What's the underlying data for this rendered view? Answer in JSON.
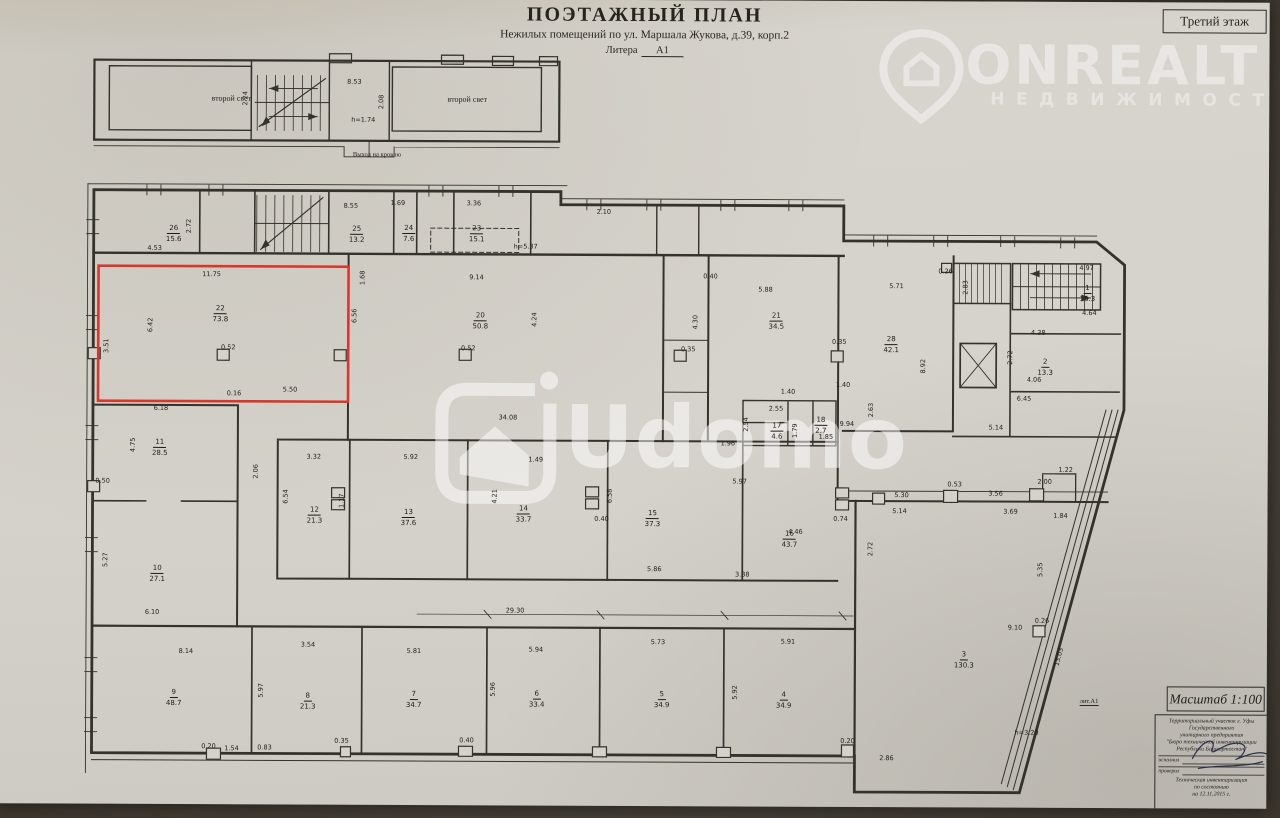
{
  "meta": {
    "title": "ПОЭТАЖНЫЙ ПЛАН",
    "subtitle": "Нежилых помещений по ул. Маршала Жукова, д.39, корп.2",
    "litera_label": "Литера",
    "litera_value": "А1",
    "floor": "Третий этаж"
  },
  "watermarks": {
    "onrealt": {
      "name": "ONREALT",
      "sub": "НЕДВИЖИМОСТЬ"
    },
    "udomo": {
      "name": "Udomo"
    }
  },
  "scale_box": "Масштаб  1:100",
  "lit_note": "лит.А1",
  "stamp": {
    "lines": [
      "Территориальный участок г. Уфы",
      "Государственного",
      "унитарного предприятия",
      "\"Бюро технической инвентаризации",
      "Республики Башкортостан\""
    ],
    "rows": [
      {
        "label": "исполнил"
      },
      {
        "label": "проверил"
      }
    ],
    "footer": [
      "Техническая инвентаризация",
      "по состоянию",
      "на  12.11.2015 г."
    ]
  },
  "plan": {
    "highlight_color": "#d6392c",
    "texts": [
      {
        "t": "второй свет",
        "x": 232,
        "y": 100,
        "fs": 8
      },
      {
        "t": "второй свет",
        "x": 468,
        "y": 100,
        "fs": 8
      },
      {
        "t": "Выход на кровлю",
        "x": 378,
        "y": 156,
        "fs": 6.5
      }
    ],
    "rooms": [
      {
        "n": "26",
        "a": "15.6",
        "x": 175,
        "y": 232
      },
      {
        "n": "25",
        "a": "13.2",
        "x": 358,
        "y": 232
      },
      {
        "n": "24",
        "a": "7.6",
        "x": 410,
        "y": 231
      },
      {
        "n": "23",
        "a": "15.1",
        "x": 478,
        "y": 231
      },
      {
        "n": "22",
        "a": "73.8",
        "x": 222,
        "y": 312
      },
      {
        "n": "20",
        "a": "50.8",
        "x": 482,
        "y": 318
      },
      {
        "n": "21",
        "a": "34.5",
        "x": 778,
        "y": 317
      },
      {
        "n": "28",
        "a": "42.1",
        "x": 893,
        "y": 340
      },
      {
        "n": "1",
        "a": "15.3",
        "x": 1089,
        "y": 288
      },
      {
        "n": "2",
        "a": "13.3",
        "x": 1047,
        "y": 362
      },
      {
        "n": "17",
        "a": "4.6",
        "x": 779,
        "y": 427
      },
      {
        "n": "18",
        "a": "2.7",
        "x": 823,
        "y": 421
      },
      {
        "n": "16",
        "a": "43.7",
        "x": 792,
        "y": 535
      },
      {
        "n": "11",
        "a": "28.5",
        "x": 162,
        "y": 446
      },
      {
        "n": "10",
        "a": "27.1",
        "x": 160,
        "y": 572
      },
      {
        "n": "12",
        "a": "21.3",
        "x": 317,
        "y": 513
      },
      {
        "n": "13",
        "a": "37.6",
        "x": 411,
        "y": 515
      },
      {
        "n": "14",
        "a": "33.7",
        "x": 526,
        "y": 511
      },
      {
        "n": "15",
        "a": "37.3",
        "x": 655,
        "y": 515
      },
      {
        "n": "9",
        "a": "48.7",
        "x": 177,
        "y": 696
      },
      {
        "n": "8",
        "a": "21.3",
        "x": 311,
        "y": 699
      },
      {
        "n": "7",
        "a": "34.7",
        "x": 417,
        "y": 697
      },
      {
        "n": "6",
        "a": "33.4",
        "x": 540,
        "y": 696
      },
      {
        "n": "5",
        "a": "34.9",
        "x": 665,
        "y": 696
      },
      {
        "n": "4",
        "a": "34.9",
        "x": 787,
        "y": 696
      },
      {
        "n": "3",
        "a": "130.3",
        "x": 967,
        "y": 655
      }
    ],
    "dims": [
      {
        "t": "8.53",
        "x": 355,
        "y": 83
      },
      {
        "t": "2.08",
        "x": 382,
        "y": 103,
        "v": 1
      },
      {
        "t": "h=1.74",
        "x": 364,
        "y": 121
      },
      {
        "t": "2.24",
        "x": 246,
        "y": 100,
        "v": 1
      },
      {
        "t": "4.53",
        "x": 156,
        "y": 250
      },
      {
        "t": "2.72",
        "x": 190,
        "y": 228,
        "v": 1
      },
      {
        "t": "8.55",
        "x": 352,
        "y": 207
      },
      {
        "t": "1.69",
        "x": 399,
        "y": 204
      },
      {
        "t": "3.36",
        "x": 475,
        "y": 204
      },
      {
        "t": "h=5.37",
        "x": 527,
        "y": 247
      },
      {
        "t": "2.10",
        "x": 605,
        "y": 212
      },
      {
        "t": "11.75",
        "x": 213,
        "y": 276
      },
      {
        "t": "6.42",
        "x": 152,
        "y": 327,
        "v": 1
      },
      {
        "t": "3.51",
        "x": 108,
        "y": 348,
        "v": 1
      },
      {
        "t": "0.52",
        "x": 230,
        "y": 349
      },
      {
        "t": "5.50",
        "x": 292,
        "y": 391
      },
      {
        "t": "0.16",
        "x": 236,
        "y": 395
      },
      {
        "t": "6.56",
        "x": 356,
        "y": 317,
        "v": 1
      },
      {
        "t": "1.68",
        "x": 364,
        "y": 279,
        "v": 1
      },
      {
        "t": "9.14",
        "x": 478,
        "y": 278
      },
      {
        "t": "4.24",
        "x": 536,
        "y": 320,
        "v": 1
      },
      {
        "t": "0.52",
        "x": 470,
        "y": 349
      },
      {
        "t": "4.30",
        "x": 697,
        "y": 322,
        "v": 1
      },
      {
        "t": "0.35",
        "x": 690,
        "y": 349
      },
      {
        "t": "5.88",
        "x": 767,
        "y": 289
      },
      {
        "t": "0.40",
        "x": 712,
        "y": 276
      },
      {
        "t": "0.35",
        "x": 841,
        "y": 341
      },
      {
        "t": "5.71",
        "x": 898,
        "y": 285
      },
      {
        "t": "8.92",
        "x": 925,
        "y": 365,
        "v": 1
      },
      {
        "t": "0.26",
        "x": 947,
        "y": 270
      },
      {
        "t": "1.40",
        "x": 845,
        "y": 384
      },
      {
        "t": "4.97",
        "x": 1088,
        "y": 266
      },
      {
        "t": "4.64",
        "x": 1091,
        "y": 311
      },
      {
        "t": "2.83",
        "x": 967,
        "y": 286,
        "v": 1
      },
      {
        "t": "4.38",
        "x": 1040,
        "y": 331
      },
      {
        "t": "2.72",
        "x": 1012,
        "y": 356,
        "v": 1
      },
      {
        "t": "4.06",
        "x": 1036,
        "y": 378
      },
      {
        "t": "6.45",
        "x": 1026,
        "y": 397
      },
      {
        "t": "5.14",
        "x": 998,
        "y": 426
      },
      {
        "t": "34.08",
        "x": 510,
        "y": 418
      },
      {
        "t": "1.49",
        "x": 538,
        "y": 460
      },
      {
        "t": "1.96",
        "x": 730,
        "y": 443
      },
      {
        "t": "5.97",
        "x": 742,
        "y": 481
      },
      {
        "t": "2.55",
        "x": 778,
        "y": 408
      },
      {
        "t": "2.54",
        "x": 748,
        "y": 424,
        "v": 1
      },
      {
        "t": "1.79",
        "x": 797,
        "y": 430,
        "v": 1
      },
      {
        "t": "1.85",
        "x": 828,
        "y": 436
      },
      {
        "t": "2.63",
        "x": 873,
        "y": 409,
        "v": 1
      },
      {
        "t": "9.94",
        "x": 849,
        "y": 423
      },
      {
        "t": "6.18",
        "x": 163,
        "y": 410
      },
      {
        "t": "4.75",
        "x": 135,
        "y": 447,
        "v": 1
      },
      {
        "t": "0.50",
        "x": 105,
        "y": 483
      },
      {
        "t": "2.06",
        "x": 258,
        "y": 473,
        "v": 1
      },
      {
        "t": "5.27",
        "x": 108,
        "y": 562,
        "v": 1
      },
      {
        "t": "6.10",
        "x": 155,
        "y": 614
      },
      {
        "t": "8.14",
        "x": 189,
        "y": 653
      },
      {
        "t": "3.32",
        "x": 316,
        "y": 458
      },
      {
        "t": "5.92",
        "x": 413,
        "y": 458
      },
      {
        "t": "1.17",
        "x": 344,
        "y": 502,
        "v": 1
      },
      {
        "t": "6.54",
        "x": 288,
        "y": 498,
        "v": 1
      },
      {
        "t": "4.21",
        "x": 497,
        "y": 497,
        "v": 1
      },
      {
        "t": "6.58",
        "x": 612,
        "y": 496,
        "v": 1
      },
      {
        "t": "0.40",
        "x": 604,
        "y": 519
      },
      {
        "t": "5.86",
        "x": 657,
        "y": 569
      },
      {
        "t": "3.38",
        "x": 745,
        "y": 574
      },
      {
        "t": "4.46",
        "x": 798,
        "y": 531
      },
      {
        "t": "2.72",
        "x": 873,
        "y": 548,
        "v": 1
      },
      {
        "t": "29.30",
        "x": 518,
        "y": 611
      },
      {
        "t": "3.54",
        "x": 311,
        "y": 646
      },
      {
        "t": "5.81",
        "x": 417,
        "y": 652
      },
      {
        "t": "5.94",
        "x": 539,
        "y": 650
      },
      {
        "t": "5.73",
        "x": 661,
        "y": 642
      },
      {
        "t": "5.91",
        "x": 791,
        "y": 641
      },
      {
        "t": "5.97",
        "x": 264,
        "y": 692,
        "v": 1
      },
      {
        "t": "5.96",
        "x": 496,
        "y": 690,
        "v": 1
      },
      {
        "t": "5.92",
        "x": 738,
        "y": 692,
        "v": 1
      },
      {
        "t": "1.54",
        "x": 235,
        "y": 750
      },
      {
        "t": "0.83",
        "x": 268,
        "y": 749
      },
      {
        "t": "0.20",
        "x": 212,
        "y": 748
      },
      {
        "t": "0.35",
        "x": 345,
        "y": 742
      },
      {
        "t": "0.40",
        "x": 470,
        "y": 741
      },
      {
        "t": "0.20",
        "x": 851,
        "y": 740
      },
      {
        "t": "9.10",
        "x": 1018,
        "y": 626
      },
      {
        "t": "0.26",
        "x": 1045,
        "y": 619
      },
      {
        "t": "13.03",
        "x": 1062,
        "y": 655,
        "r": -75
      },
      {
        "t": "h=3.20",
        "x": 1030,
        "y": 731
      },
      {
        "t": "2.86",
        "x": 890,
        "y": 757
      },
      {
        "t": "5.35",
        "x": 1043,
        "y": 568,
        "v": 1
      },
      {
        "t": "5.30",
        "x": 904,
        "y": 494
      },
      {
        "t": "5.14",
        "x": 902,
        "y": 510
      },
      {
        "t": "3.56",
        "x": 998,
        "y": 492
      },
      {
        "t": "3.69",
        "x": 1013,
        "y": 510
      },
      {
        "t": "1.84",
        "x": 1063,
        "y": 514
      },
      {
        "t": "2.00",
        "x": 1047,
        "y": 480
      },
      {
        "t": "1.22",
        "x": 1068,
        "y": 468
      },
      {
        "t": "0.53",
        "x": 957,
        "y": 483
      },
      {
        "t": "0.74",
        "x": 843,
        "y": 518
      },
      {
        "t": "1.40",
        "x": 790,
        "y": 391
      }
    ]
  }
}
